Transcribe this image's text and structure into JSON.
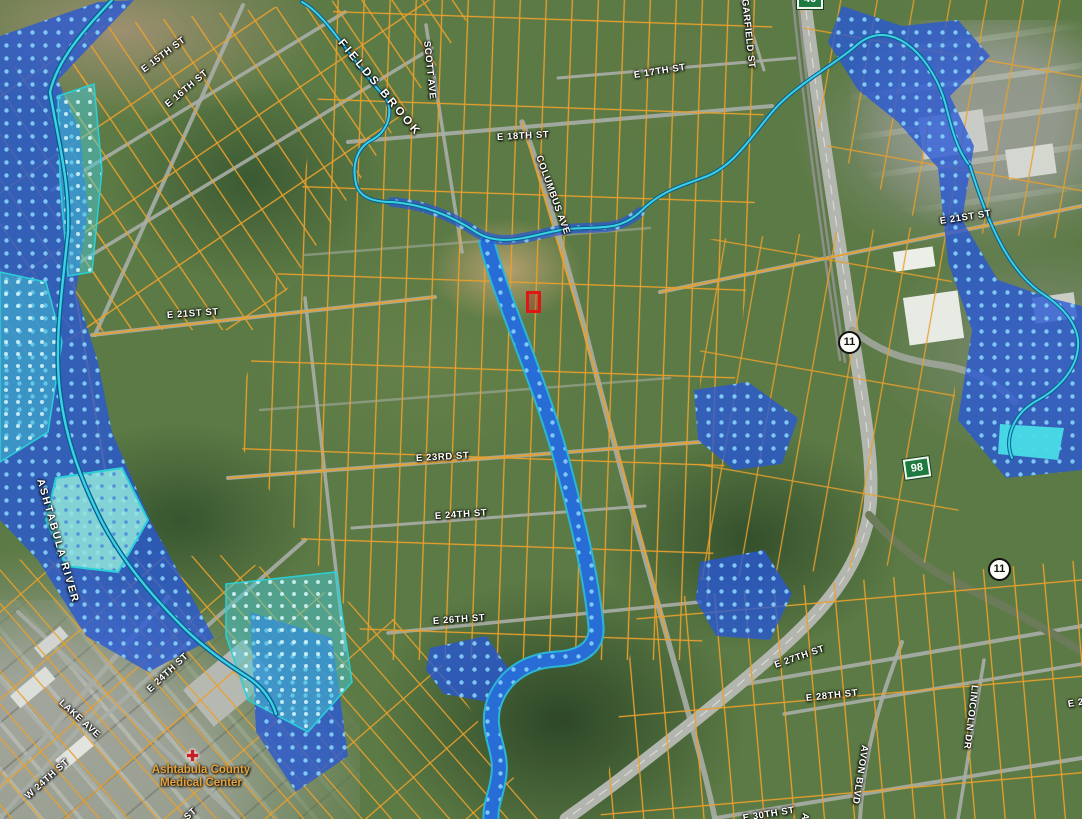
{
  "map": {
    "title": "Aerial parcel and flood zone map",
    "water_labels": {
      "fields_brook": "FIELDS BROOK",
      "ashtabula_river": "ASHTABULA RIVER"
    },
    "street_labels": {
      "e15": "E 15TH ST",
      "e16": "E 16TH ST",
      "scott": "SCOTT AVE",
      "e17": "E 17TH ST",
      "e18": "E 18TH ST",
      "columbus": "COLUMBUS AVE",
      "garfield": "GARFIELD ST",
      "e21_left": "E 21ST ST",
      "e21_right": "E 21ST ST",
      "e23": "E 23RD ST",
      "e24": "E 24TH ST",
      "e26": "E 26TH ST",
      "e24_sw": "E 24TH ST",
      "lake": "LAKE AVE",
      "w24": "W 24TH ST",
      "e27": "E 27TH ST",
      "e28": "E 28TH ST",
      "lincoln": "LINCOLN DR",
      "avon": "AVON BLVD",
      "e30": "E 30TH ST",
      "partial_ab": "AB",
      "partial_st": "ST",
      "partial_e2": "E 2"
    },
    "route_shields": {
      "circle_11_upper": "11",
      "circle_11_lower": "11",
      "square_98": "98",
      "square_top_partial": "46"
    },
    "poi": {
      "medical_line1": "Ashtabula County",
      "medical_line2": "Medical Center",
      "medical_icon": "✚"
    },
    "legend_colors": {
      "parcel_line": "#EEA12D",
      "flood_zone_fill": "#2857D6",
      "flood_zone_dot": "#82CDF8",
      "floodway_fill": "#46C8D4",
      "stream": "#3FD4E4",
      "selected_parcel": "#E01515"
    }
  }
}
